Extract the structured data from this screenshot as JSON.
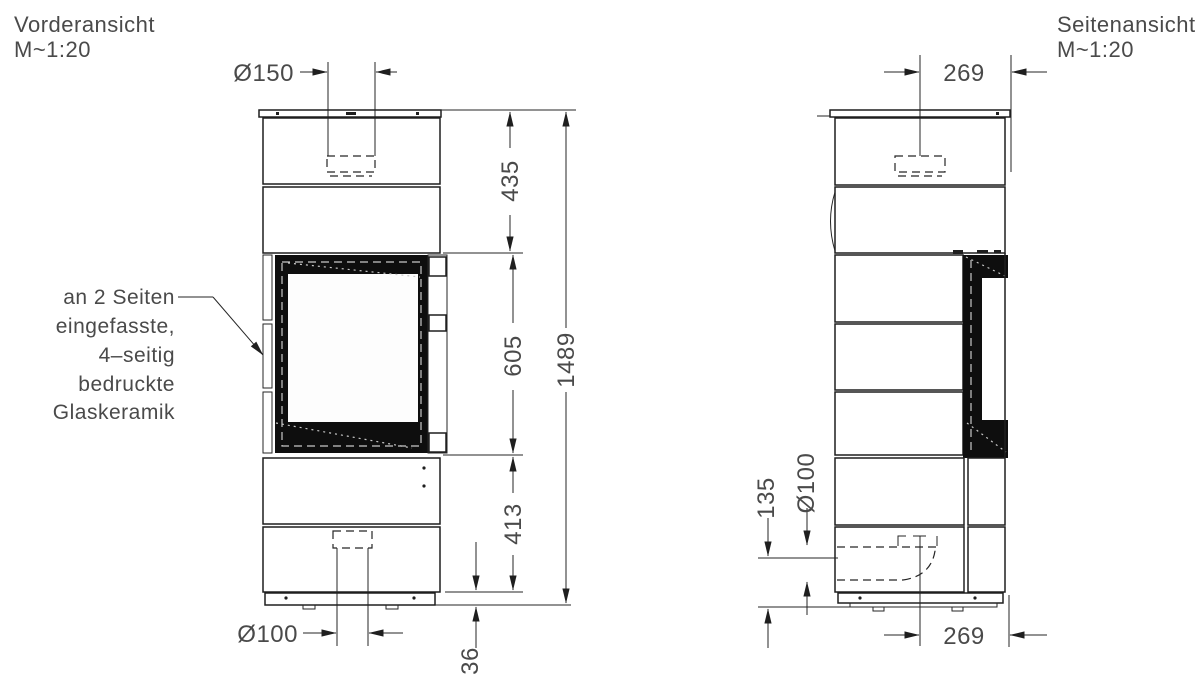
{
  "front_view": {
    "title": "Vorderansicht",
    "scale": "M~1:20",
    "dimensions": {
      "flue_diameter": "Ø150",
      "top_section_height": "435",
      "window_height": "605",
      "lower_section_height": "413",
      "total_height": "1489",
      "base_height": "36",
      "air_inlet_diameter": "Ø100"
    },
    "annotation": {
      "lines": [
        "an 2 Seiten",
        "eingefasste,",
        "4–seitig",
        "bedruckte",
        "Glaskeramik"
      ]
    }
  },
  "side_view": {
    "title": "Seitenansicht",
    "scale": "M~1:20",
    "dimensions": {
      "flue_center_to_front": "269",
      "inlet_center_to_front": "269",
      "inlet_pipe_diameter": "Ø100",
      "inlet_axis_height": "135"
    }
  }
}
